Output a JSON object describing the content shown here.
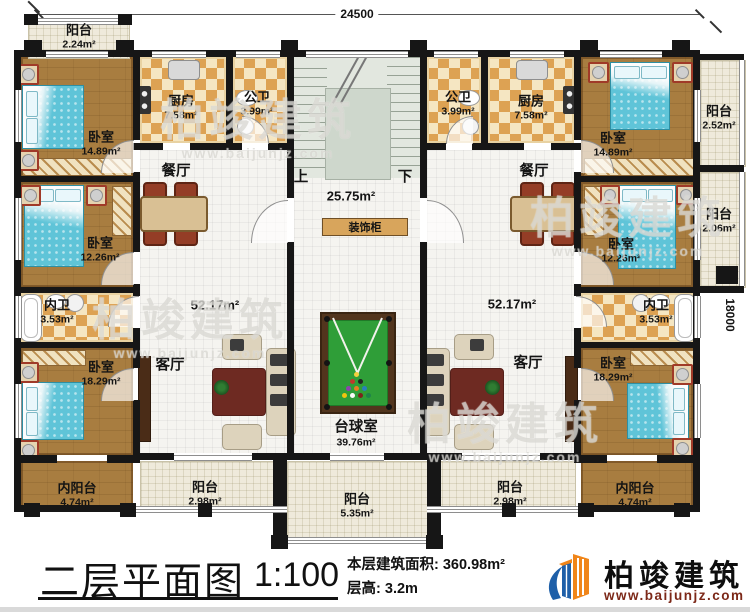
{
  "titleblock": {
    "title": "二层平面图",
    "scale": "1:100",
    "area_label": "本层建筑面积:",
    "area_value": "360.98m²",
    "height_label": "层高:",
    "height_value": "3.2m"
  },
  "brand": {
    "name": "柏竣建筑",
    "site": "www.baijunjz.com"
  },
  "watermark": {
    "text": "柏竣建筑",
    "site": "www.baijunjz.com"
  },
  "dimensions": {
    "width": "24500",
    "height": "18000"
  },
  "stair": {
    "up": "上",
    "down": "下"
  },
  "cabinet": {
    "label": "装饰柜"
  },
  "rooms": {
    "balcony_tl": {
      "name": "阳台",
      "area": "2.24m²"
    },
    "bedroom1_l": {
      "name": "卧室",
      "area": "14.89m²"
    },
    "kitchen_l": {
      "name": "厨房",
      "area": "7.58m²"
    },
    "bath_l": {
      "name": "公卫",
      "area": "3.99m²"
    },
    "bath_r": {
      "name": "公卫",
      "area": "3.99m²"
    },
    "kitchen_r": {
      "name": "厨房",
      "area": "7.58m²"
    },
    "bedroom1_r": {
      "name": "卧室",
      "area": "14.89m²"
    },
    "balcony_tr": {
      "name": "阳台",
      "area": "2.52m²"
    },
    "dining_l": {
      "name": "餐厅",
      "area": ""
    },
    "dining_r": {
      "name": "餐厅",
      "area": ""
    },
    "bedroom2_l": {
      "name": "卧室",
      "area": "12.26m²"
    },
    "bedroom2_r": {
      "name": "卧室",
      "area": "12.26m²"
    },
    "balcony_mr": {
      "name": "阳台",
      "area": "2.06m²"
    },
    "hall_l": {
      "name": "",
      "area": "52.17m²"
    },
    "hall_r": {
      "name": "",
      "area": "52.17m²"
    },
    "stairhall": {
      "name": "",
      "area": "25.75m²"
    },
    "neiwei_l": {
      "name": "内卫",
      "area": "3.53m²"
    },
    "neiwei_r": {
      "name": "内卫",
      "area": "3.53m²"
    },
    "living_l": {
      "name": "客厅",
      "area": ""
    },
    "living_r": {
      "name": "客厅",
      "area": ""
    },
    "bedroom3_l": {
      "name": "卧室",
      "area": "18.29m²"
    },
    "bedroom3_r": {
      "name": "卧室",
      "area": "18.29m²"
    },
    "billiard": {
      "name": "台球室",
      "area": "39.76m²"
    },
    "neiyang_l": {
      "name": "内阳台",
      "area": "4.74m²"
    },
    "neiyang_r": {
      "name": "内阳台",
      "area": "4.74m²"
    },
    "balcony_bl": {
      "name": "阳台",
      "area": "2.98m²"
    },
    "balcony_bc": {
      "name": "阳台",
      "area": "5.35m²"
    },
    "balcony_br": {
      "name": "阳台",
      "area": "2.98m²"
    }
  }
}
